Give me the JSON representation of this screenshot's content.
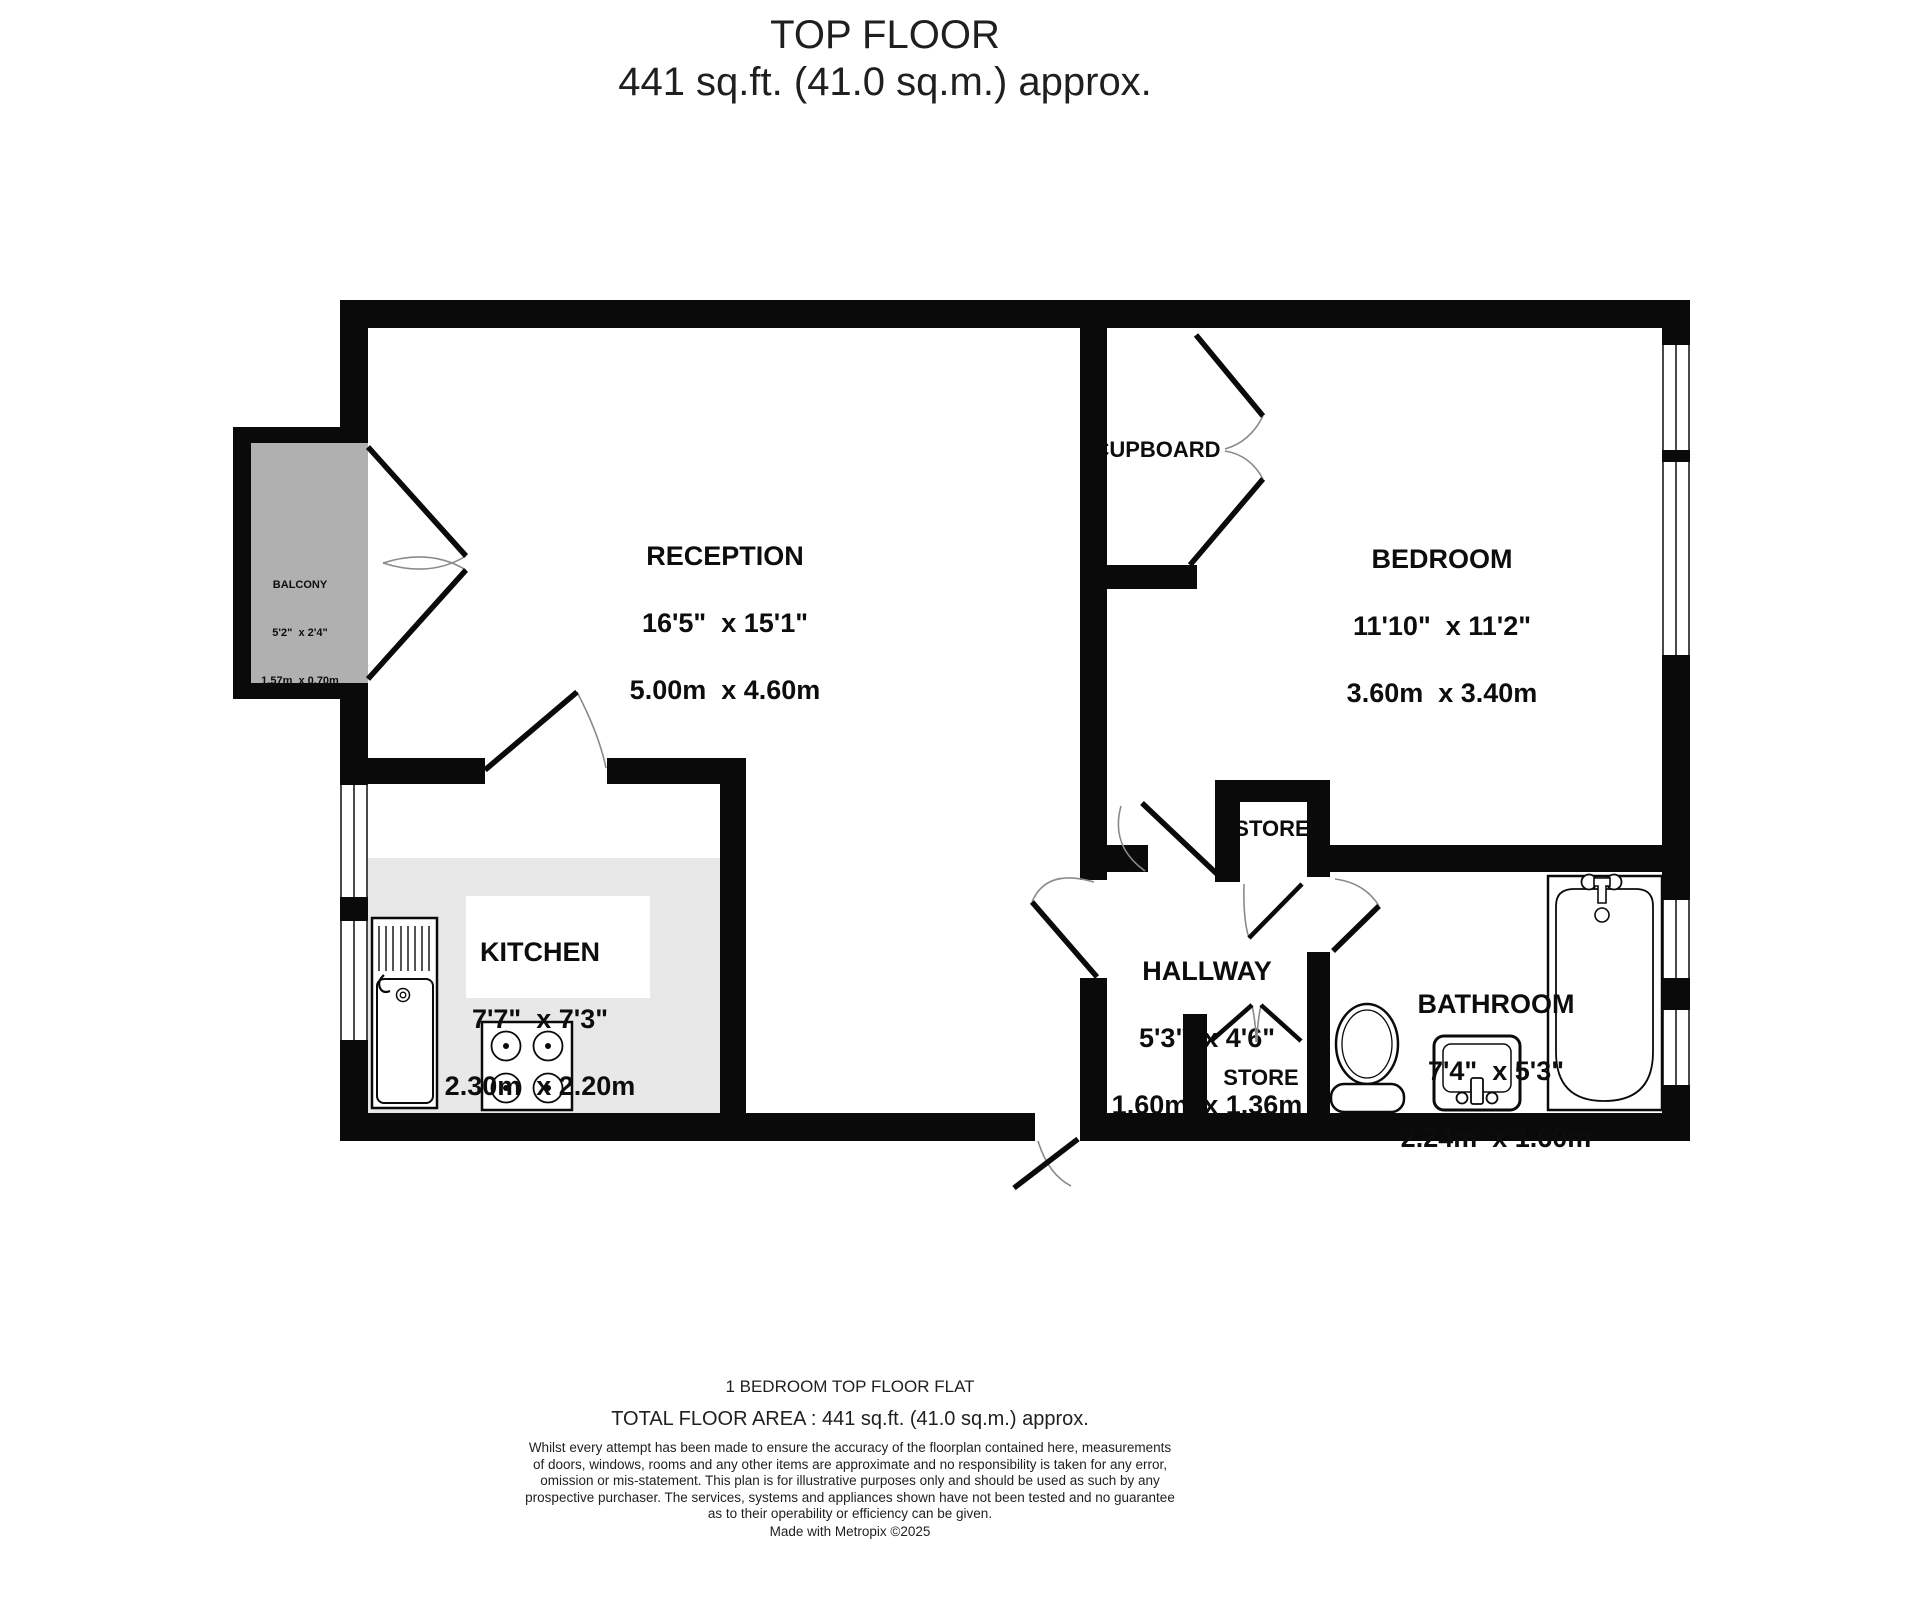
{
  "title": {
    "line1": "TOP FLOOR",
    "line2": "441 sq.ft. (41.0 sq.m.) approx."
  },
  "rooms": {
    "reception": {
      "name": "RECEPTION",
      "imperial": "16'5\"  x 15'1\"",
      "metric": "5.00m  x 4.60m"
    },
    "bedroom": {
      "name": "BEDROOM",
      "imperial": "11'10\"  x 11'2\"",
      "metric": "3.60m  x 3.40m"
    },
    "kitchen": {
      "name": "KITCHEN",
      "imperial": "7'7\"  x 7'3\"",
      "metric": "2.30m  x 2.20m"
    },
    "hallway": {
      "name": "HALLWAY",
      "imperial": "5'3\"  x 4'6\"",
      "metric": "1.60m  x 1.36m"
    },
    "bathroom": {
      "name": "BATHROOM",
      "imperial": "7'4\"  x 5'3\"",
      "metric": "2.24m  x 1.60m"
    },
    "balcony": {
      "name": "BALCONY",
      "imperial": "5'2\"  x 2'4\"",
      "metric": "1.57m  x 0.70m"
    },
    "cupboard": {
      "name": "CUPBOARD"
    },
    "store_upper": {
      "name": "STORE"
    },
    "store_lower": {
      "name": "STORE"
    }
  },
  "footer": {
    "property_type": "1 BEDROOM TOP FLOOR FLAT",
    "total_area": "TOTAL FLOOR AREA : 441 sq.ft. (41.0 sq.m.) approx.",
    "disclaimer": "Whilst every attempt has been made to ensure the accuracy of the floorplan contained here, measurements\nof doors, windows, rooms and any other items are approximate and no responsibility is taken for any error,\nomission or mis-statement. This plan is for illustrative purposes only and should be used as such by any\nprospective purchaser. The services, systems and appliances shown have not been tested and no guarantee\nas to their operability or efficiency can be given.",
    "credit": "Made with Metropix ©2025"
  },
  "colors": {
    "wall": "#0a0a0a",
    "balcony_floor": "#b0b0b0",
    "kitchen_floor": "#e8e8e8",
    "door_arc": "#8a8a8a"
  }
}
